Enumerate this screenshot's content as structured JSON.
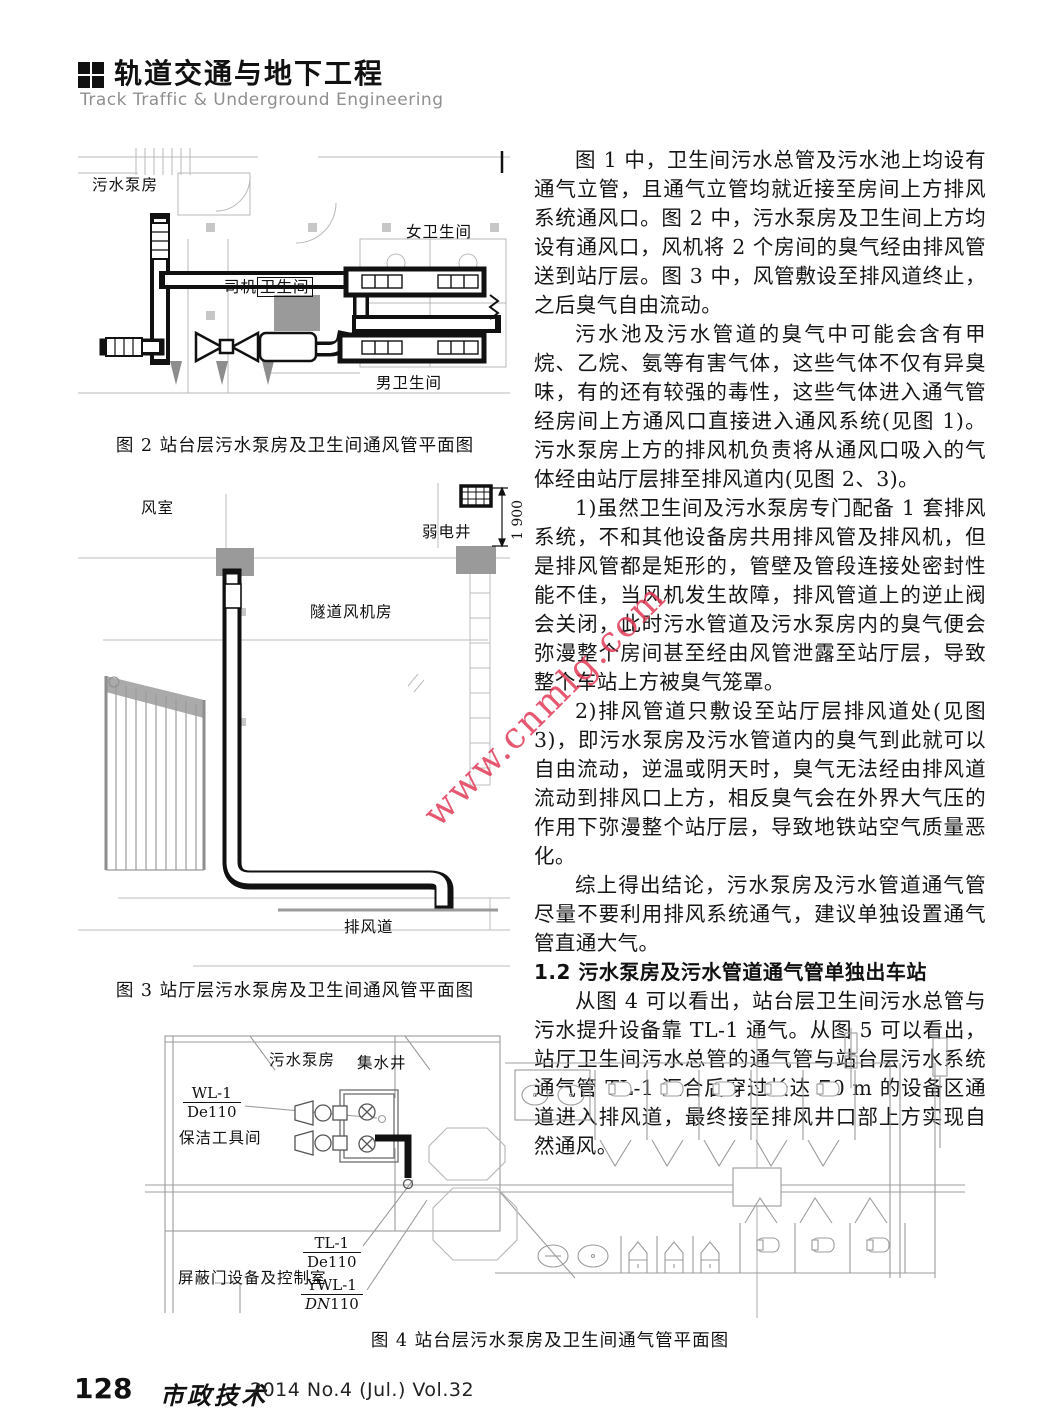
{
  "header": {
    "title": "轨道交通与地下工程",
    "subtitle": "Track Traffic &amp; Underground Engineering",
    "subtitle_plain": "Track Traffic & Underground Engineering"
  },
  "watermark": {
    "text": "www.cnmlg.com",
    "color": "#e23a58"
  },
  "article": {
    "p1": "图 1 中，卫生间污水总管及污水池上均设有通气立管，且通气立管均就近接至房间上方排风系统通风口。图 2 中，污水泵房及卫生间上方均设有通风口，风机将 2 个房间的臭气经由排风管送到站厅层。图 3 中，风管敷设至排风道终止，之后臭气自由流动。",
    "p2": "污水池及污水管道的臭气中可能会含有甲烷、乙烷、氨等有害气体，这些气体不仅有异臭味，有的还有较强的毒性，这些气体进入通气管经房间上方通风口直接进入通风系统(见图 1)。污水泵房上方的排风机负责将从通风口吸入的气体经由站厅层排至排风道内(见图 2、3)。",
    "p3": "1)虽然卫生间及污水泵房专门配备 1 套排风系统，不和其他设备房共用排风管及排风机，但是排风管都是矩形的，管壁及管段连接处密封性能不佳，当风机发生故障，排风管道上的逆止阀会关闭，此时污水管道及污水泵房内的臭气便会弥漫整个房间甚至经由风管泄露至站厅层，导致整个车站上方被臭气笼罩。",
    "p4": "2)排风管道只敷设至站厅层排风道处(见图 3)，即污水泵房及污水管道内的臭气到此就可以自由流动，逆温或阴天时，臭气无法经由排风道流动到排风口上方，相反臭气会在外界大气压的作用下弥漫整个站厅层，导致地铁站空气质量恶化。",
    "p5": "综上得出结论，污水泵房及污水管道通气管尽量不要利用排风系统通气，建议单独设置通气管直通大气。",
    "heading_1_2": "1.2  污水泵房及污水管道通气管单独出车站",
    "p6": "从图 4 可以看出，站台层卫生间污水总管与污水提升设备靠 TL-1 通气。从图 5 可以看出，站厅卫生间污水总管的通气管与站台层污水系统通气管 TL-1 汇合后穿过长达 70 m 的设备区通道进入排风道，最终接至排风井口部上方实现自然通风。"
  },
  "figure2": {
    "caption": "图 2  站台层污水泵房及卫生间通风管平面图",
    "labels": {
      "sewage_pump_room": "污水泵房",
      "women_toilet": "女卫生间",
      "driver": "司机",
      "driver_toilet": "卫生间",
      "men_toilet": "男卫生间"
    }
  },
  "figure3": {
    "caption": "图 3  站厅层污水泵房及卫生间通风管平面图",
    "labels": {
      "air_room": "风室",
      "weak_current_shaft": "弱电井",
      "dimension": "1 900",
      "tunnel_fan_room": "隧道风机房",
      "exhaust_duct": "排风道"
    }
  },
  "figure4": {
    "caption": "图 4  站台层污水泵房及卫生间通气管平面图",
    "labels": {
      "sewage_pump_room": "污水泵房",
      "sump_well": "集水井",
      "wl1_top": "WL-1",
      "wl1_bottom": "De110",
      "cleaning_tool_room": "保洁工具间",
      "psd_equipment_room": "屏蔽门设备及控制室",
      "tl1_top": "TL-1",
      "tl1_bottom": "De110",
      "ywl1_top": "YWL-1",
      "ywl1_bottom_prefix": "DN",
      "ywl1_bottom_suffix": "110"
    }
  },
  "footer": {
    "page_number": "128",
    "journal_name": "市政技术",
    "issue": "2014 No.4 (Jul.)  Vol.32"
  }
}
